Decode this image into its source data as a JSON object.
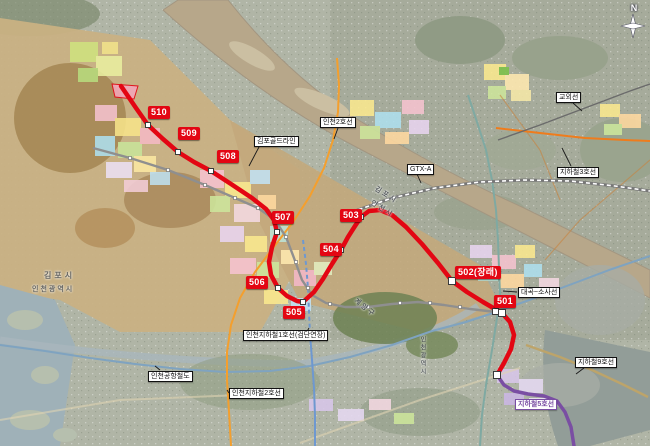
{
  "compass": {
    "n": "N"
  },
  "route": {
    "name": "red-numbered-route",
    "stations": [
      "510",
      "509",
      "508",
      "507",
      "506",
      "505",
      "504",
      "503",
      "502(장래)",
      "501"
    ]
  },
  "labels": {
    "incheon2": "인천2호선",
    "gimpo_gold": "김포골드라인",
    "gtx_a": "GTX-A",
    "gyowoe": "교외선",
    "line3": "지하철3호선",
    "daegok_sosa": "대곡~소사선",
    "line9": "지하철9호선",
    "line5": "지하철5호선",
    "incheon1_ext": "인천지하철1호선(검단연장)",
    "arex": "인천공항철도",
    "incheon2_s": "인천지하철2호선"
  },
  "boundaries": {
    "left_top": "김포시",
    "left_bottom": "인천광역시",
    "river_top": "김포시",
    "river_bottom": "인천시",
    "gyeyang": "계양구",
    "incheon_vertical": "인천광역시"
  },
  "colors": {
    "line-red": "#e30613",
    "line5-purple": "#7a4ea3",
    "gold-line-gray": "#8f8f8f",
    "line3-orange": "#ef7c1c",
    "incheon1-blue": "#6e98d0",
    "incheon2-orange": "#f49f2d",
    "arex-blue": "#7fa3c0",
    "seohae-teal": "#7fa9a2",
    "line9-gold": "#bda46a",
    "gyowoe-gray": "#6b6b6b"
  }
}
